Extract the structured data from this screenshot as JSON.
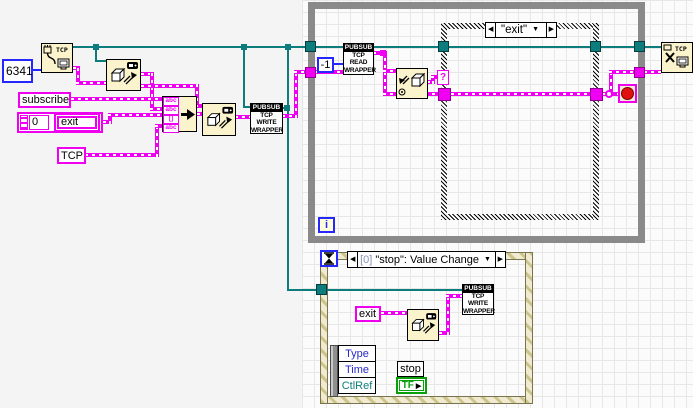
{
  "diagram": {
    "constants": {
      "port": "6341",
      "subscribe": "subscribe",
      "cluster_num": "0",
      "cluster_str": "exit",
      "topic": "TCP",
      "timeout": "-1",
      "exit_msg": "exit"
    },
    "nodes": {
      "tcp_open_label": "TCP",
      "tcp_close_label": "TCP",
      "pubsub_header": "PUBSUB",
      "write_l1": "TCP",
      "write_l2": "WRITE",
      "write_l3": "WRAPPER",
      "read_l1": "TCP",
      "read_l2": "READ",
      "read_l3": "WRAPPER",
      "concat_row1": "abc",
      "concat_row2": "abc",
      "concat_row3": "[]",
      "concat_row4": "abc"
    },
    "while_loop": {
      "iteration": "i"
    },
    "case_structure": {
      "selector": "\"exit\"",
      "selector_tunnel": "?"
    },
    "event_structure": {
      "index": "[0]",
      "event": "\"stop\": Value Change"
    },
    "event_data": {
      "f1": "Type",
      "f2": "Time",
      "f3": "CtlRef"
    },
    "stop_terminal": {
      "label": "stop",
      "bool": "TF"
    },
    "glyphs": {
      "left": "◀",
      "right": "▶",
      "down": "▼"
    },
    "colors": {
      "wire_teal": "#0d7c7c",
      "wire_magenta": "#f000f0",
      "numeric_blue": "#2626ff",
      "boolean_green": "#0aa00a",
      "loop_border": "#8a8a8a",
      "node_bg": "#fbf3cc"
    }
  }
}
